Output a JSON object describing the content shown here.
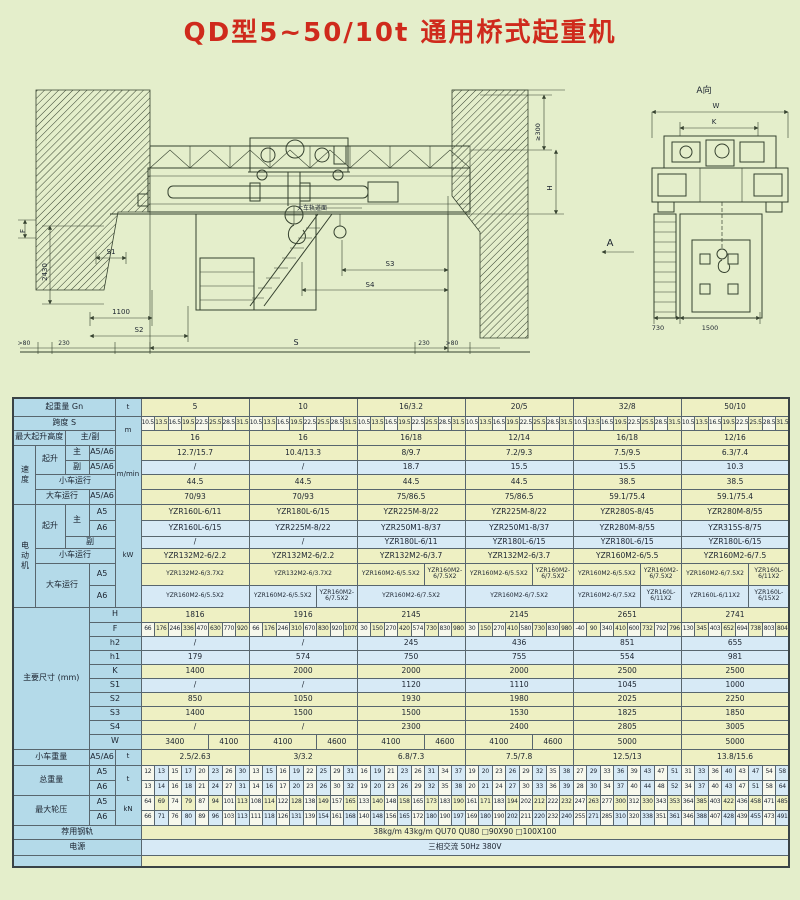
{
  "title": "QD型5~50/10t 通用桥式起重机",
  "colors": {
    "page": "#e4eecb",
    "title": "#cf2a1c",
    "label_bg": "#b4dae9",
    "cell_yellow": "#eef0c3",
    "cell_blue": "#d7eaf6",
    "cell_alt": "#f7f8ec",
    "line": "#35412f",
    "border": "#58666e"
  },
  "drawing": {
    "labels": [
      {
        "t": "F",
        "x": 25,
        "y": 231,
        "rot": -90,
        "fs": 7
      },
      {
        "t": "2430",
        "x": 47,
        "y": 272,
        "rot": -90,
        "fs": 7
      },
      {
        "t": "S1",
        "x": 111,
        "y": 254,
        "fs": 7
      },
      {
        "t": "1100",
        "x": 121,
        "y": 314,
        "fs": 7
      },
      {
        "t": "S2",
        "x": 139,
        "y": 332,
        "fs": 7
      },
      {
        "t": ">80",
        "x": 24,
        "y": 345,
        "fs": 6
      },
      {
        "t": "230",
        "x": 64,
        "y": 345,
        "fs": 6
      },
      {
        "t": "S",
        "x": 296,
        "y": 345,
        "fs": 8
      },
      {
        "t": "230",
        "x": 424,
        "y": 345,
        "fs": 6
      },
      {
        "t": ">80",
        "x": 452,
        "y": 345,
        "fs": 6
      },
      {
        "t": "大车轨道面",
        "x": 312,
        "y": 210,
        "fs": 6
      },
      {
        "t": "S3",
        "x": 390,
        "y": 266,
        "fs": 7
      },
      {
        "t": "S4",
        "x": 370,
        "y": 287,
        "fs": 7
      },
      {
        "t": "≥300",
        "x": 540,
        "y": 132,
        "rot": -90,
        "fs": 6.5
      },
      {
        "t": "H",
        "x": 552,
        "y": 188,
        "rot": -90,
        "fs": 7
      },
      {
        "t": "A",
        "x": 610,
        "y": 246,
        "fs": 10
      },
      {
        "t": "A向",
        "x": 704,
        "y": 93,
        "fs": 9
      },
      {
        "t": "W",
        "x": 716,
        "y": 108,
        "fs": 7
      },
      {
        "t": "K",
        "x": 714,
        "y": 124,
        "fs": 7
      },
      {
        "t": "730",
        "x": 658,
        "y": 330,
        "fs": 6.5
      },
      {
        "t": "1500",
        "x": 710,
        "y": 330,
        "fs": 6.5
      }
    ]
  },
  "table": {
    "col_widths": [
      22,
      30,
      24,
      26,
      26,
      13.5,
      13.5,
      13.5,
      13.5,
      13.5,
      13.5,
      13.5,
      13.5,
      13.5,
      13.5,
      13.5,
      13.5,
      13.5,
      13.5,
      13.5,
      13.5,
      13.5,
      13.5,
      13.5,
      13.5,
      13.5,
      13.5,
      13.5,
      13.5,
      13.5,
      13.5,
      13.5,
      13.5,
      13.5,
      13.5,
      13.5,
      13.5,
      13.5,
      13.5,
      13.5,
      13.5,
      13.5,
      13.5,
      13.5,
      13.5,
      13.5,
      13.5,
      13.5,
      13.5,
      13.5,
      13.5,
      13.5,
      13.5
    ],
    "rows": [
      {
        "bg": "y",
        "h": 18,
        "label": [
          {
            "t": "起重量 Gn",
            "c": 4
          }
        ],
        "unit": {
          "t": "t"
        },
        "cells": [
          "5",
          "10",
          "16/3.2",
          "20/5",
          "32/8",
          "50/10"
        ]
      },
      {
        "bg": "y",
        "h": 14,
        "sub": true,
        "label": [
          {
            "t": "跨度 S",
            "c": 4
          }
        ],
        "unit": {
          "t": "m",
          "r": 2
        },
        "cells": [
          "10.5",
          "13.5",
          "16.5",
          "19.5",
          "22.5",
          "25.5",
          "28.5",
          "31.5",
          "10.5",
          "13.5",
          "16.5",
          "19.5",
          "22.5",
          "25.5",
          "28.5",
          "31.5",
          "10.5",
          "13.5",
          "16.5",
          "19.5",
          "22.5",
          "25.5",
          "28.5",
          "31.5",
          "10.5",
          "13.5",
          "16.5",
          "19.5",
          "22.5",
          "25.5",
          "28.5",
          "31.5",
          "10.5",
          "13.5",
          "16.5",
          "19.5",
          "22.5",
          "25.5",
          "28.5",
          "31.5",
          "10.5",
          "13.5",
          "16.5",
          "19.5",
          "22.5",
          "25.5",
          "28.5",
          "31.5"
        ]
      },
      {
        "bg": "y",
        "h": 15,
        "label": [
          {
            "t": "最大起升高度",
            "c": 2
          },
          {
            "t": "主/副",
            "c": 2
          }
        ],
        "cells": [
          "16",
          "16",
          "16/18",
          "12/14",
          "16/18",
          "12/16"
        ]
      },
      {
        "bg": "y",
        "h": 15,
        "label": [
          {
            "t": "速度",
            "r": 4,
            "v": 1
          },
          {
            "t": "起升",
            "r": 2
          },
          {
            "t": "主"
          },
          {
            "t": "A5/A6"
          }
        ],
        "unit": {
          "t": "m/min",
          "r": 4
        },
        "cells": [
          "12.7/15.7",
          "10.4/13.3",
          "8/9.7",
          "7.2/9.3",
          "7.5/9.5",
          "6.3/7.4"
        ]
      },
      {
        "bg": "b",
        "h": 14,
        "label": [
          {
            "t": "副"
          },
          {
            "t": "A5/A6"
          }
        ],
        "cells": [
          "/",
          "/",
          "18.7",
          "15.5",
          "15.5",
          "10.3"
        ]
      },
      {
        "bg": "y",
        "h": 15,
        "label": [
          {
            "t": "小车运行",
            "c": 3
          }
        ],
        "cells": [
          "44.5",
          "44.5",
          "44.5",
          "44.5",
          "38.5",
          "38.5"
        ]
      },
      {
        "bg": "y",
        "h": 15,
        "label": [
          {
            "t": "大车运行",
            "c": 2
          },
          {
            "t": "A5/A6"
          }
        ],
        "cells": [
          "70/93",
          "70/93",
          "75/86.5",
          "75/86.5",
          "59.1/75.4",
          "59.1/75.4"
        ]
      },
      {
        "bg": "y",
        "h": 16,
        "label": [
          {
            "t": "电动机",
            "r": 6,
            "v": 1
          },
          {
            "t": "起升",
            "r": 3
          },
          {
            "t": "主",
            "r": 2
          },
          {
            "t": "A5"
          }
        ],
        "unit": {
          "t": "kW",
          "r": 6
        },
        "cells": [
          "YZR160L-6/11",
          "YZR180L-6/15",
          "YZR225M-8/22",
          "YZR225M-8/22",
          "YZR280S-8/45",
          "YZR280M-8/55"
        ]
      },
      {
        "bg": "b",
        "h": 16,
        "label": [
          {
            "t": "A6"
          }
        ],
        "cells": [
          "YZR160L-6/15",
          "YZR225M-8/22",
          "YZR250M1-8/37",
          "YZR250M1-8/37",
          "YZR280M-8/55",
          "YZR315S-8/75"
        ]
      },
      {
        "bg": "b",
        "h": 12,
        "label": [
          {
            "t": "副",
            "c": 2
          }
        ],
        "cells": [
          "/",
          "/",
          "YZR180L-6/11",
          "YZR180L-6/15",
          "YZR180L-6/15",
          "YZR180L-6/15"
        ]
      },
      {
        "bg": "y",
        "h": 15,
        "label": [
          {
            "t": "小车运行",
            "c": 3
          }
        ],
        "cells": [
          "YZR132M2-6/2.2",
          "YZR132M2-6/2.2",
          "YZR132M2-6/3.7",
          "YZR132M2-6/3.7",
          "YZR160M2-6/5.5",
          "YZR160M2-6/7.5"
        ]
      },
      {
        "bg": "y",
        "h": 22,
        "label": [
          {
            "t": "大车运行",
            "c": 2,
            "r": 2
          },
          {
            "t": "A5"
          }
        ],
        "cells": [
          {
            "t": "YZR132M2-6/3.7X2",
            "s": 8,
            "w": 1
          },
          {
            "t": "YZR132M2-6/3.7X2",
            "s": 8,
            "w": 1
          },
          {
            "t": "YZR160M2-6/5.5X2",
            "s": 5,
            "w": 1
          },
          {
            "t": "YZR160M2-6/7.5X2",
            "s": 3,
            "w": 1
          },
          {
            "t": "YZR160M2-6/5.5X2",
            "s": 5,
            "w": 1
          },
          {
            "t": "YZR160M2-6/7.5X2",
            "s": 3,
            "w": 1
          },
          {
            "t": "YZR160M2-6/5.5X2",
            "s": 5,
            "w": 1
          },
          {
            "t": "YZR160M2-6/7.5X2",
            "s": 3,
            "w": 1
          },
          {
            "t": "YZR160M2-6/7.5X2",
            "s": 5,
            "w": 1
          },
          {
            "t": "YZR160L-6/11X2",
            "s": 3,
            "w": 1
          }
        ]
      },
      {
        "bg": "b",
        "h": 22,
        "label": [
          {
            "t": "A6"
          }
        ],
        "cells": [
          {
            "t": "YZR160M2-6/5.5X2",
            "s": 8,
            "w": 1
          },
          {
            "t": "YZR160M2-6/5.5X2",
            "s": 5,
            "w": 1
          },
          {
            "t": "YZR160M2-6/7.5X2",
            "s": 3,
            "w": 1
          },
          {
            "t": "YZR160M2-6/7.5X2",
            "s": 8,
            "w": 1
          },
          {
            "t": "YZR160M2-6/7.5X2",
            "s": 8,
            "w": 1
          },
          {
            "t": "YZR160M2-6/7.5X2",
            "s": 5,
            "w": 1
          },
          {
            "t": "YZR160L-6/11X2",
            "s": 3,
            "w": 1
          },
          {
            "t": "YZR160L-6/11X2",
            "s": 5,
            "w": 1
          },
          {
            "t": "YZR160L-6/15X2",
            "s": 3,
            "w": 1
          }
        ]
      },
      {
        "bg": "y",
        "h": 15,
        "label": [
          {
            "t": "主要尺寸 (mm)",
            "c": 3,
            "r": 10
          },
          {
            "t": "H",
            "c": 2
          }
        ],
        "cells": [
          "1816",
          "1916",
          "2145",
          "2145",
          "2651",
          "2741"
        ]
      },
      {
        "bg": "y",
        "h": 14,
        "sub": true,
        "label": [
          {
            "t": "F",
            "c": 2
          }
        ],
        "cells": [
          "66",
          "176",
          "246",
          "336",
          "470",
          "630",
          "770",
          "920",
          "66",
          "176",
          "246",
          "310",
          "670",
          "830",
          "920",
          "1070",
          "30",
          "150",
          "270",
          "420",
          "574",
          "730",
          "830",
          "980",
          "30",
          "150",
          "270",
          "410",
          "580",
          "730",
          "830",
          "980",
          "-40",
          "90",
          "340",
          "410",
          "600",
          "732",
          "792",
          "796",
          "130",
          "345",
          "403",
          "652",
          "694",
          "738",
          "803",
          "804"
        ]
      },
      {
        "bg": "b",
        "h": 14,
        "label": [
          {
            "t": "h2",
            "c": 2
          }
        ],
        "cells": [
          "/",
          "/",
          "245",
          "436",
          "851",
          "655"
        ]
      },
      {
        "bg": "b",
        "h": 14,
        "label": [
          {
            "t": "h1",
            "c": 2
          }
        ],
        "cells": [
          "179",
          "574",
          "750",
          "755",
          "554",
          "981"
        ]
      },
      {
        "bg": "y",
        "h": 14,
        "label": [
          {
            "t": "K",
            "c": 2
          }
        ],
        "cells": [
          "1400",
          "2000",
          "2000",
          "2000",
          "2500",
          "2500"
        ]
      },
      {
        "bg": "b",
        "h": 14,
        "label": [
          {
            "t": "S1",
            "c": 2
          }
        ],
        "cells": [
          "/",
          "/",
          "1120",
          "1110",
          "1045",
          "1000"
        ]
      },
      {
        "bg": "y",
        "h": 14,
        "label": [
          {
            "t": "S2",
            "c": 2
          }
        ],
        "cells": [
          "850",
          "1050",
          "1930",
          "1980",
          "2025",
          "2250"
        ]
      },
      {
        "bg": "y",
        "h": 14,
        "label": [
          {
            "t": "S3",
            "c": 2
          }
        ],
        "cells": [
          "1400",
          "1500",
          "1500",
          "1530",
          "1825",
          "1850"
        ]
      },
      {
        "bg": "y",
        "h": 14,
        "label": [
          {
            "t": "S4",
            "c": 2
          }
        ],
        "cells": [
          "/",
          "/",
          "2300",
          "2400",
          "2805",
          "3005"
        ]
      },
      {
        "bg": "y",
        "h": 15,
        "label": [
          {
            "t": "W",
            "c": 2
          }
        ],
        "cells": [
          {
            "t": "3400",
            "s": 5
          },
          {
            "t": "4100",
            "s": 3
          },
          {
            "t": "4100",
            "s": 5
          },
          {
            "t": "4600",
            "s": 3
          },
          {
            "t": "4100",
            "s": 5
          },
          {
            "t": "4600",
            "s": 3
          },
          {
            "t": "4100",
            "s": 5
          },
          {
            "t": "4600",
            "s": 3
          },
          {
            "t": "5000",
            "s": 8
          },
          {
            "t": "5000",
            "s": 8
          }
        ]
      },
      {
        "bg": "y",
        "h": 16,
        "label": [
          {
            "t": "小车重量",
            "c": 3
          },
          {
            "t": "A5/A6"
          }
        ],
        "unit": {
          "t": "t"
        },
        "cells": [
          "2.5/2.63",
          "3/3.2",
          "6.8/7.3",
          "7.5/7.8",
          "12.5/13",
          "13.8/15.6"
        ]
      },
      {
        "bg": "b",
        "h": 15,
        "sub": true,
        "label": [
          {
            "t": "总重量",
            "c": 3,
            "r": 2
          },
          {
            "t": "A5"
          }
        ],
        "unit": {
          "t": "t",
          "r": 2
        },
        "cells": [
          "12",
          "13",
          "15",
          "17",
          "20",
          "23",
          "26",
          "30",
          "13",
          "15",
          "16",
          "19",
          "22",
          "25",
          "29",
          "31",
          "16",
          "19",
          "21",
          "23",
          "26",
          "31",
          "34",
          "37",
          "19",
          "20",
          "23",
          "26",
          "29",
          "32",
          "35",
          "38",
          "27",
          "29",
          "33",
          "36",
          "39",
          "43",
          "47",
          "51",
          "31",
          "33",
          "36",
          "40",
          "43",
          "47",
          "54",
          "58"
        ]
      },
      {
        "bg": "b",
        "h": 15,
        "sub": true,
        "label": [
          {
            "t": "A6"
          }
        ],
        "cells": [
          "13",
          "14",
          "16",
          "18",
          "21",
          "24",
          "27",
          "31",
          "14",
          "16",
          "17",
          "20",
          "23",
          "26",
          "30",
          "32",
          "19",
          "20",
          "23",
          "26",
          "29",
          "32",
          "35",
          "38",
          "20",
          "21",
          "24",
          "27",
          "30",
          "33",
          "36",
          "39",
          "28",
          "30",
          "34",
          "37",
          "40",
          "44",
          "48",
          "52",
          "34",
          "37",
          "40",
          "43",
          "47",
          "51",
          "58",
          "64"
        ]
      },
      {
        "bg": "y",
        "h": 15,
        "sub": true,
        "label": [
          {
            "t": "最大轮压",
            "c": 3,
            "r": 2
          },
          {
            "t": "A5"
          }
        ],
        "unit": {
          "t": "kN",
          "r": 2
        },
        "cells": [
          "64",
          "69",
          "74",
          "79",
          "87",
          "94",
          "101",
          "113",
          "108",
          "114",
          "122",
          "128",
          "138",
          "149",
          "157",
          "165",
          "133",
          "140",
          "148",
          "158",
          "165",
          "173",
          "183",
          "190",
          "161",
          "171",
          "183",
          "194",
          "202",
          "212",
          "222",
          "232",
          "247",
          "263",
          "277",
          "300",
          "312",
          "330",
          "343",
          "353",
          "364",
          "385",
          "403",
          "422",
          "436",
          "458",
          "471",
          "485"
        ]
      },
      {
        "bg": "b",
        "h": 15,
        "sub": true,
        "label": [
          {
            "t": "A6"
          }
        ],
        "cells": [
          "66",
          "71",
          "76",
          "80",
          "89",
          "96",
          "103",
          "113",
          "111",
          "118",
          "126",
          "131",
          "139",
          "154",
          "161",
          "168",
          "140",
          "148",
          "156",
          "165",
          "172",
          "180",
          "190",
          "197",
          "169",
          "180",
          "190",
          "202",
          "211",
          "220",
          "232",
          "240",
          "255",
          "271",
          "285",
          "310",
          "320",
          "338",
          "351",
          "361",
          "346",
          "388",
          "407",
          "428",
          "439",
          "455",
          "473",
          "491"
        ]
      },
      {
        "bg": "y",
        "h": 14,
        "label": [
          {
            "t": "荐用钢轨",
            "c": 5
          }
        ],
        "cells": [
          {
            "t": "38kg/m  43kg/m  QU70  QU80  □90X90  □100X100",
            "s": 48
          }
        ]
      },
      {
        "bg": "b",
        "h": 16,
        "label": [
          {
            "t": "电源",
            "c": 5
          }
        ],
        "cells": [
          {
            "t": "三相交流  50Hz  380V",
            "s": 48
          }
        ]
      },
      {
        "bg": "y",
        "h": 12,
        "label": [
          {
            "t": "",
            "c": 5
          }
        ],
        "cells": [
          {
            "t": "",
            "s": 48
          }
        ]
      }
    ]
  }
}
